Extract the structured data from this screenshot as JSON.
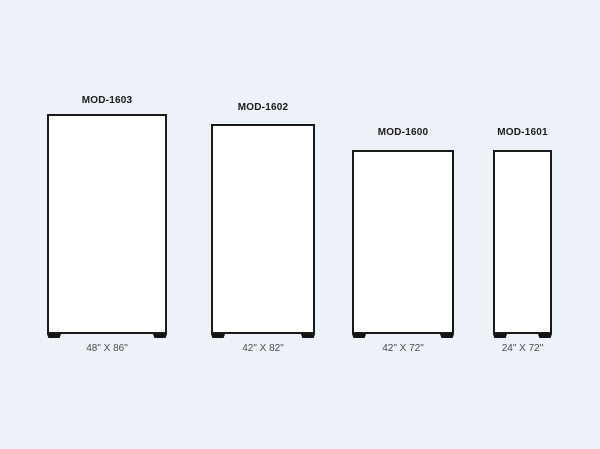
{
  "canvas": {
    "background_color": "#edf2f8",
    "outline_color": "#1a1a1a",
    "model_text_color": "#1a1a1a",
    "size_text_color": "#4d4d4d",
    "fill_color": "#ffffff"
  },
  "panels": [
    {
      "model": "MOD-1603",
      "size_label": "48\" X 86\"",
      "width_in": 48,
      "height_in": 86
    },
    {
      "model": "MOD-1602",
      "size_label": "42\" X 82\"",
      "width_in": 42,
      "height_in": 82
    },
    {
      "model": "MOD-1600",
      "size_label": "42\" X 72\"",
      "width_in": 42,
      "height_in": 72
    },
    {
      "model": "MOD-1601",
      "size_label": "24\" X 72\"",
      "width_in": 24,
      "height_in": 72
    }
  ]
}
